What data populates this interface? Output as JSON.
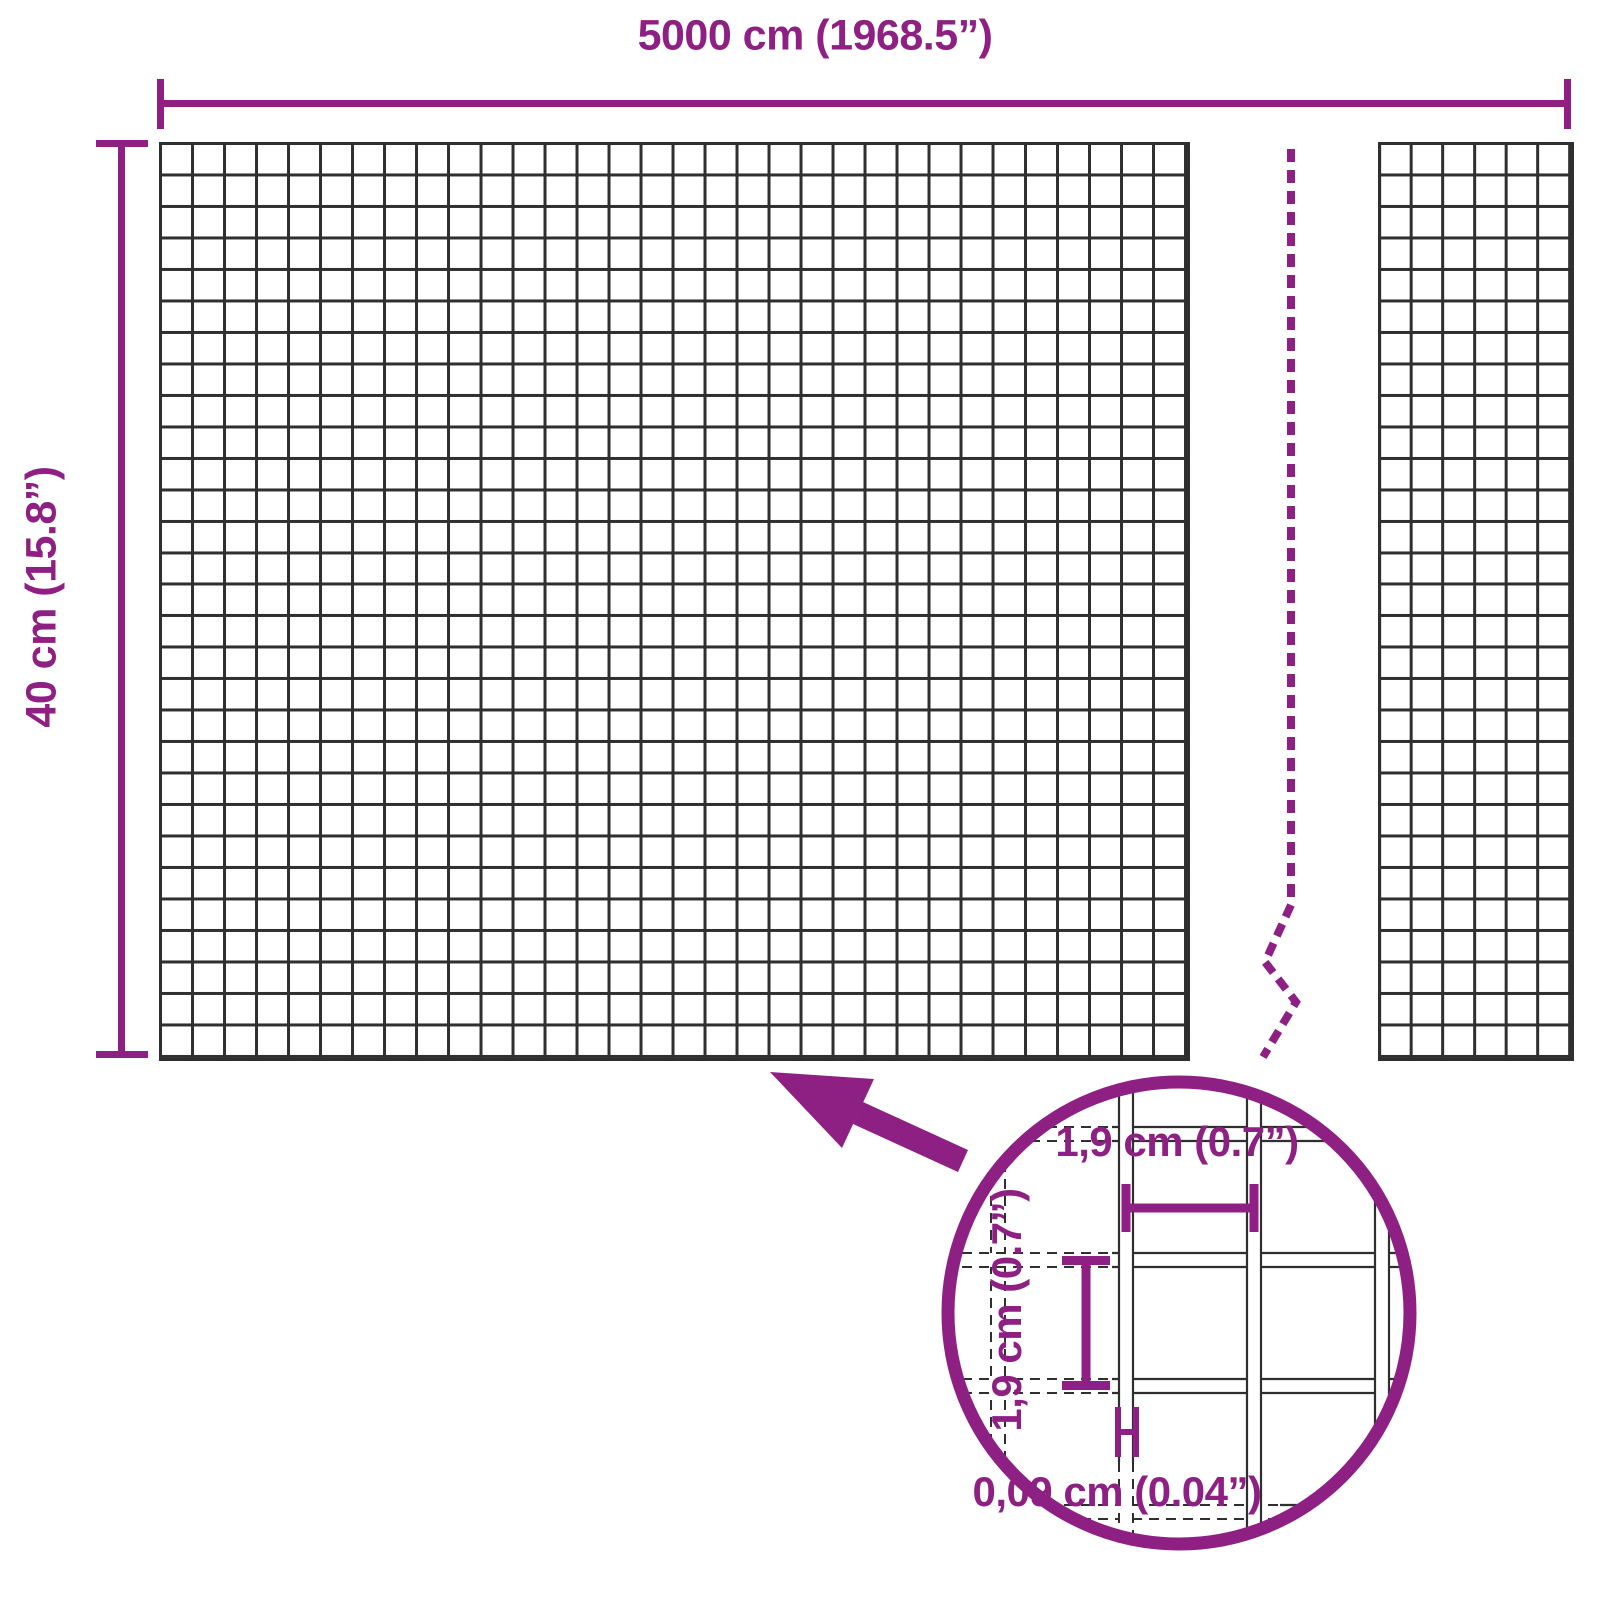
{
  "diagram": {
    "kind": "wire-mesh-product-dimensions",
    "colors": {
      "accent": "#8E2083",
      "mesh_line": "#2f2f2f",
      "background": "#ffffff"
    },
    "overall_dimensions": {
      "width_label": "5000 cm (1968.5”)",
      "height_label": "40 cm (15.8”)"
    },
    "detail_inset": {
      "opening_width_label": "1,9 cm (0.7”)",
      "opening_height_label": "1,9 cm (0.7”)",
      "wire_thickness_label": "0,09 cm (0.04”)"
    }
  }
}
